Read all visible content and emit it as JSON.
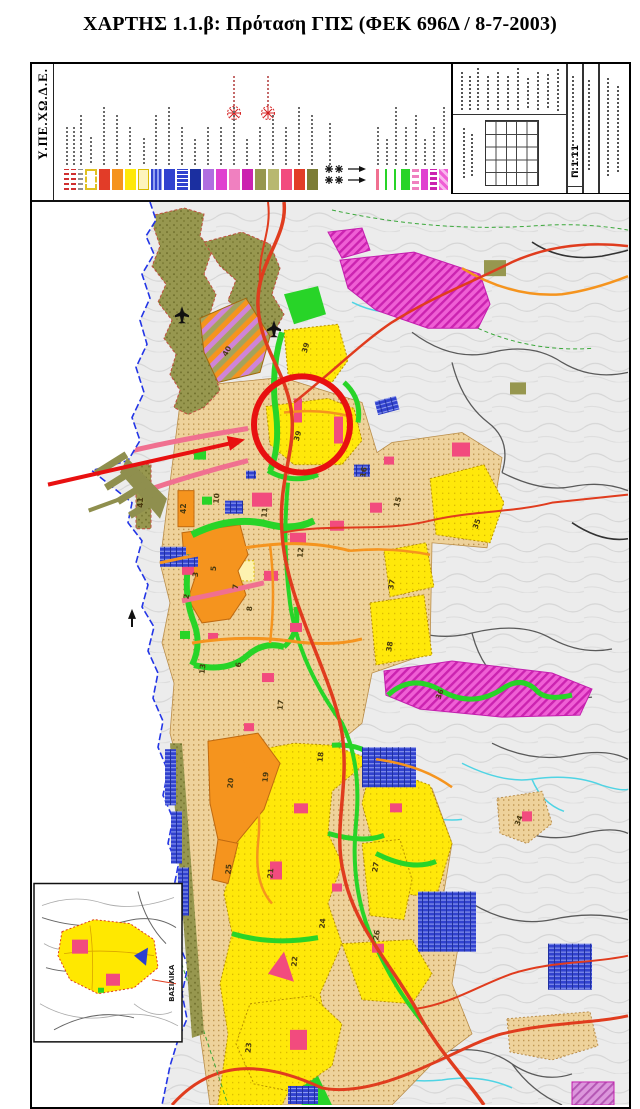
{
  "document": {
    "title": "ΧΑΡΤΗΣ 1.1.β: Πρόταση ΓΠΣ (ΦΕΚ 696Δ / 8-7-2003)",
    "agency": "Υ.ΠΕ.ΧΩ.Δ.Ε."
  },
  "title_block": {
    "number": "Π.1.11"
  },
  "inset": {
    "label": "ΒΑΣΙΛΙΚΑ"
  },
  "annotation": {
    "shapes": [
      "red-circle",
      "red-arrow"
    ],
    "color": "#e81010"
  },
  "legend": {
    "swatches": [
      {
        "css": "width:5px;background:repeating-linear-gradient(0deg,#d03030 0 2px,#ffffff 2px 5px)"
      },
      {
        "css": "width:5px;background:repeating-linear-gradient(0deg,#d03030 0 2px,#ffffff 2px 5px)"
      },
      {
        "css": "width:5px;background:repeating-linear-gradient(0deg,#909090 0 2px,#ffffff 2px 5px)"
      },
      {
        "css": "width:12px;background:#ffffff;border:2px dashed #e0c020"
      },
      {
        "css": "background:#e23c28"
      },
      {
        "css": "background:#f5941e"
      },
      {
        "css": "background:#ffe80a"
      },
      {
        "css": "background:#fdf4bc;border:1.5px solid #d9bb00"
      },
      {
        "css": "background:repeating-linear-gradient(90deg,#3142cf 0 2px,#93a0f0 2px 4px)"
      },
      {
        "css": "background:#3142cf"
      },
      {
        "css": "background:repeating-linear-gradient(0deg,#3142cf 0 3px,#ffffff 3px 4px)"
      },
      {
        "css": "background:#1b2fa0"
      },
      {
        "css": "background:#b06fe0"
      },
      {
        "css": "background:#e040d0"
      },
      {
        "css": "background:#f080c0"
      },
      {
        "css": "background:#cb23b0"
      },
      {
        "css": "background:#97974f"
      },
      {
        "css": "background:#b8b870"
      },
      {
        "css": "background:#f24b7e"
      },
      {
        "css": "background:#e23c28"
      },
      {
        "css": "background:#7c7c35"
      },
      {
        "css": "width:7px;background:linear-gradient(90deg,transparent 0 2px,#f07090 2px 5px,transparent 5px)"
      },
      {
        "css": "width:7px;background:linear-gradient(90deg,transparent 0 2px,#28d428 2px 4px,transparent 4px)"
      },
      {
        "css": "width:7px;background:linear-gradient(90deg,transparent 0 2px,#28d428 2px 4px,transparent 4px)"
      },
      {
        "css": "width:9px;background:#28d428"
      },
      {
        "css": "width:7px;background:repeating-linear-gradient(0deg,#f080c0 0 3px,#ffffff 3px 6px)"
      },
      {
        "css": "width:7px;background:#e040d0"
      },
      {
        "css": "width:7px;background:repeating-linear-gradient(0deg,#cb23b0 0 3px,#ffffff 3px 5px)"
      },
      {
        "css": "width:9px;background:repeating-linear-gradient(45deg,#ef5fd5 0 3px,#f9b8ee 3px 6px)"
      }
    ],
    "symbols": {
      "black": "stars-and-arrows",
      "red": "red-star-markers"
    }
  },
  "map": {
    "colors": {
      "sea": "#ffffff",
      "terrain": "#ececec",
      "urban_fabric": "#eed29b",
      "expansion_yellow": "#ffe80a",
      "green_space": "#28d428",
      "forest_olive": "#97974f",
      "orange_center": "#f5941e",
      "magenta_zone": "#ef5fd5",
      "blue_facility": "#3142cf",
      "crimson_blob": "#f24b7e",
      "red_road": "#e03c1e",
      "orange_road": "#f5941e",
      "pink_road": "#f07090",
      "stream_cyan": "#4fd4e4",
      "coastline_blue": "#2335e6",
      "annotation_red": "#e81010"
    },
    "districts": [
      {
        "label": "41"
      },
      {
        "label": "42"
      },
      {
        "label": "40"
      },
      {
        "label": "39"
      },
      {
        "label": "39"
      },
      {
        "label": "10"
      },
      {
        "label": "11"
      },
      {
        "label": "12"
      },
      {
        "label": "16"
      },
      {
        "label": "15"
      },
      {
        "label": "3"
      },
      {
        "label": "5"
      },
      {
        "label": "2"
      },
      {
        "label": "7"
      },
      {
        "label": "8"
      },
      {
        "label": "13"
      },
      {
        "label": "6"
      },
      {
        "label": "37"
      },
      {
        "label": "35"
      },
      {
        "label": "38"
      },
      {
        "label": "36"
      },
      {
        "label": "20"
      },
      {
        "label": "19"
      },
      {
        "label": "18"
      },
      {
        "label": "25"
      },
      {
        "label": "21"
      },
      {
        "label": "27"
      },
      {
        "label": "24"
      },
      {
        "label": "26"
      },
      {
        "label": "22"
      },
      {
        "label": "34"
      },
      {
        "label": "23"
      },
      {
        "label": "17"
      }
    ]
  }
}
